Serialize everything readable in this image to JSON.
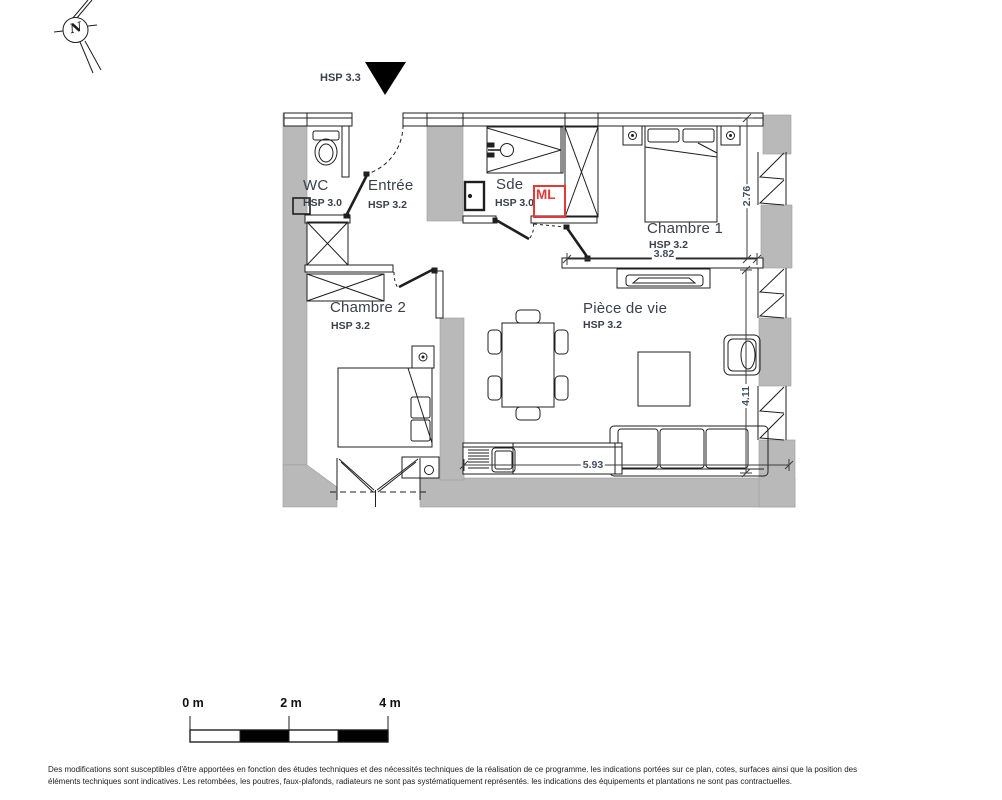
{
  "meta": {
    "north_label": "N"
  },
  "entrance": {
    "hsp_label": "HSP 3.3"
  },
  "rooms": {
    "wc": {
      "name": "WC",
      "hsp": "HSP 3.0"
    },
    "entree": {
      "name": "Entrée",
      "hsp": "HSP 3.2"
    },
    "sde": {
      "name": "Sde",
      "hsp": "HSP 3.0"
    },
    "chambre1": {
      "name": "Chambre 1",
      "hsp": "HSP 3.2"
    },
    "chambre2": {
      "name": "Chambre 2",
      "hsp": "HSP 3.2"
    },
    "piece_de_vie": {
      "name": "Pièce de vie",
      "hsp": "HSP 3.2"
    }
  },
  "appliances": {
    "washing_machine_label": "ML"
  },
  "dimensions": {
    "chambre1_height_m": "2.76",
    "chambre1_width_m": "3.82",
    "living_height_m": "4.11",
    "living_width_m": "5.93"
  },
  "scale_bar": {
    "labels": [
      "0 m",
      "2 m",
      "4 m"
    ]
  },
  "disclaimer": {
    "line1": "Des modifications sont susceptibles d'être apportées en fonction des études techniques et des nécessités techniques de la réalisation de ce programme. les indications portées sur ce plan, cotes, surfaces ainsi que la position des",
    "line2": "éléments techniques sont indicatives. Les retombées, les poutres, faux-plafonds, radiateurs ne sont pas systématiquement représentés. les indications des équipements et plantations ne sont pas contractuelles."
  },
  "colors": {
    "wall_gray": "#b9b9b9",
    "accent_red": "#e53935",
    "line_black": "#1f1f1f",
    "dimension_text": "#3f4e63",
    "label_text": "#3a404c"
  }
}
